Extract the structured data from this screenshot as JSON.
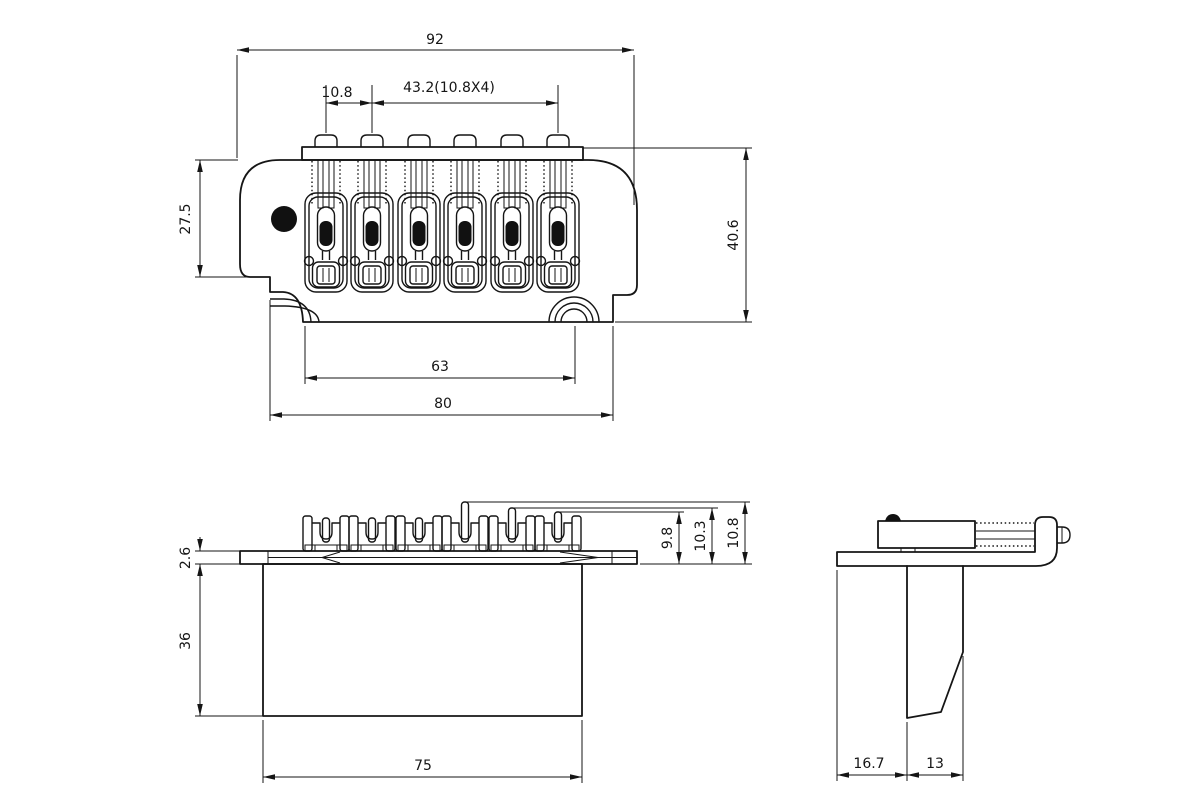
{
  "drawing": {
    "kind": "engineering-drawing",
    "part": "tremolo-bridge-assembly",
    "units_implied": "mm",
    "colors": {
      "line": "#151515",
      "background": "#ffffff",
      "fill_black": "#111111"
    }
  },
  "top_view": {
    "dims": {
      "overall_width": "92",
      "string_pitch": "10.8",
      "string_span": "43.2(10.8X4)",
      "body_depth_left": "27.5",
      "body_depth_right": "40.6",
      "bottom_edge_span": "63",
      "flange_width": "80"
    }
  },
  "front_view": {
    "dims": {
      "plate_thickness": "2.6",
      "block_height": "36",
      "block_width": "75",
      "saddle_height_a": "9.8",
      "saddle_height_b": "10.3",
      "saddle_height_c": "10.8"
    }
  },
  "side_view": {
    "dims": {
      "plate_overhang": "16.7",
      "block_depth": "13"
    }
  }
}
